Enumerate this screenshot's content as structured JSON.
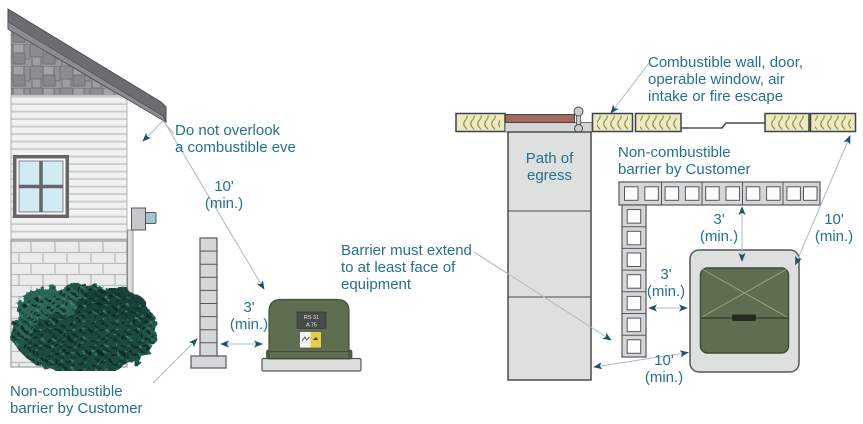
{
  "colors": {
    "label_text": "#26708f",
    "arrow_head": "#1e5068",
    "leader_line": "#a9bbc4",
    "equipment_green": "#5f6e50",
    "door_brown": "#a26a5c",
    "insulation_yellow": "#ece9c0",
    "masonry_gray": "#d4d6d7",
    "roof_gray": "#6b6d70"
  },
  "left_diagram": {
    "eve_note": "Do not overlook\na combustible eve",
    "dim_10": "10'\n(min.)",
    "dim_3": "3'\n(min.)",
    "barrier_note": "Non-combustible\nbarrier by Customer",
    "plate": {
      "line1": "RS 31",
      "line2": "A 75"
    }
  },
  "right_diagram": {
    "wall_note": "Combustible wall, door,\noperable window, air\nintake or fire escape",
    "egress": "Path of\negress",
    "barrier_note": "Non-combustible\nbarrier by Customer",
    "extend_note": "Barrier must extend\nto at least face of\nequipment",
    "dim_3_top": "3'\n(min.)",
    "dim_3_side": "3'\n(min.)",
    "dim_10_right": "10'\n(min.)",
    "dim_10_bottom": "10'\n(min.)"
  }
}
